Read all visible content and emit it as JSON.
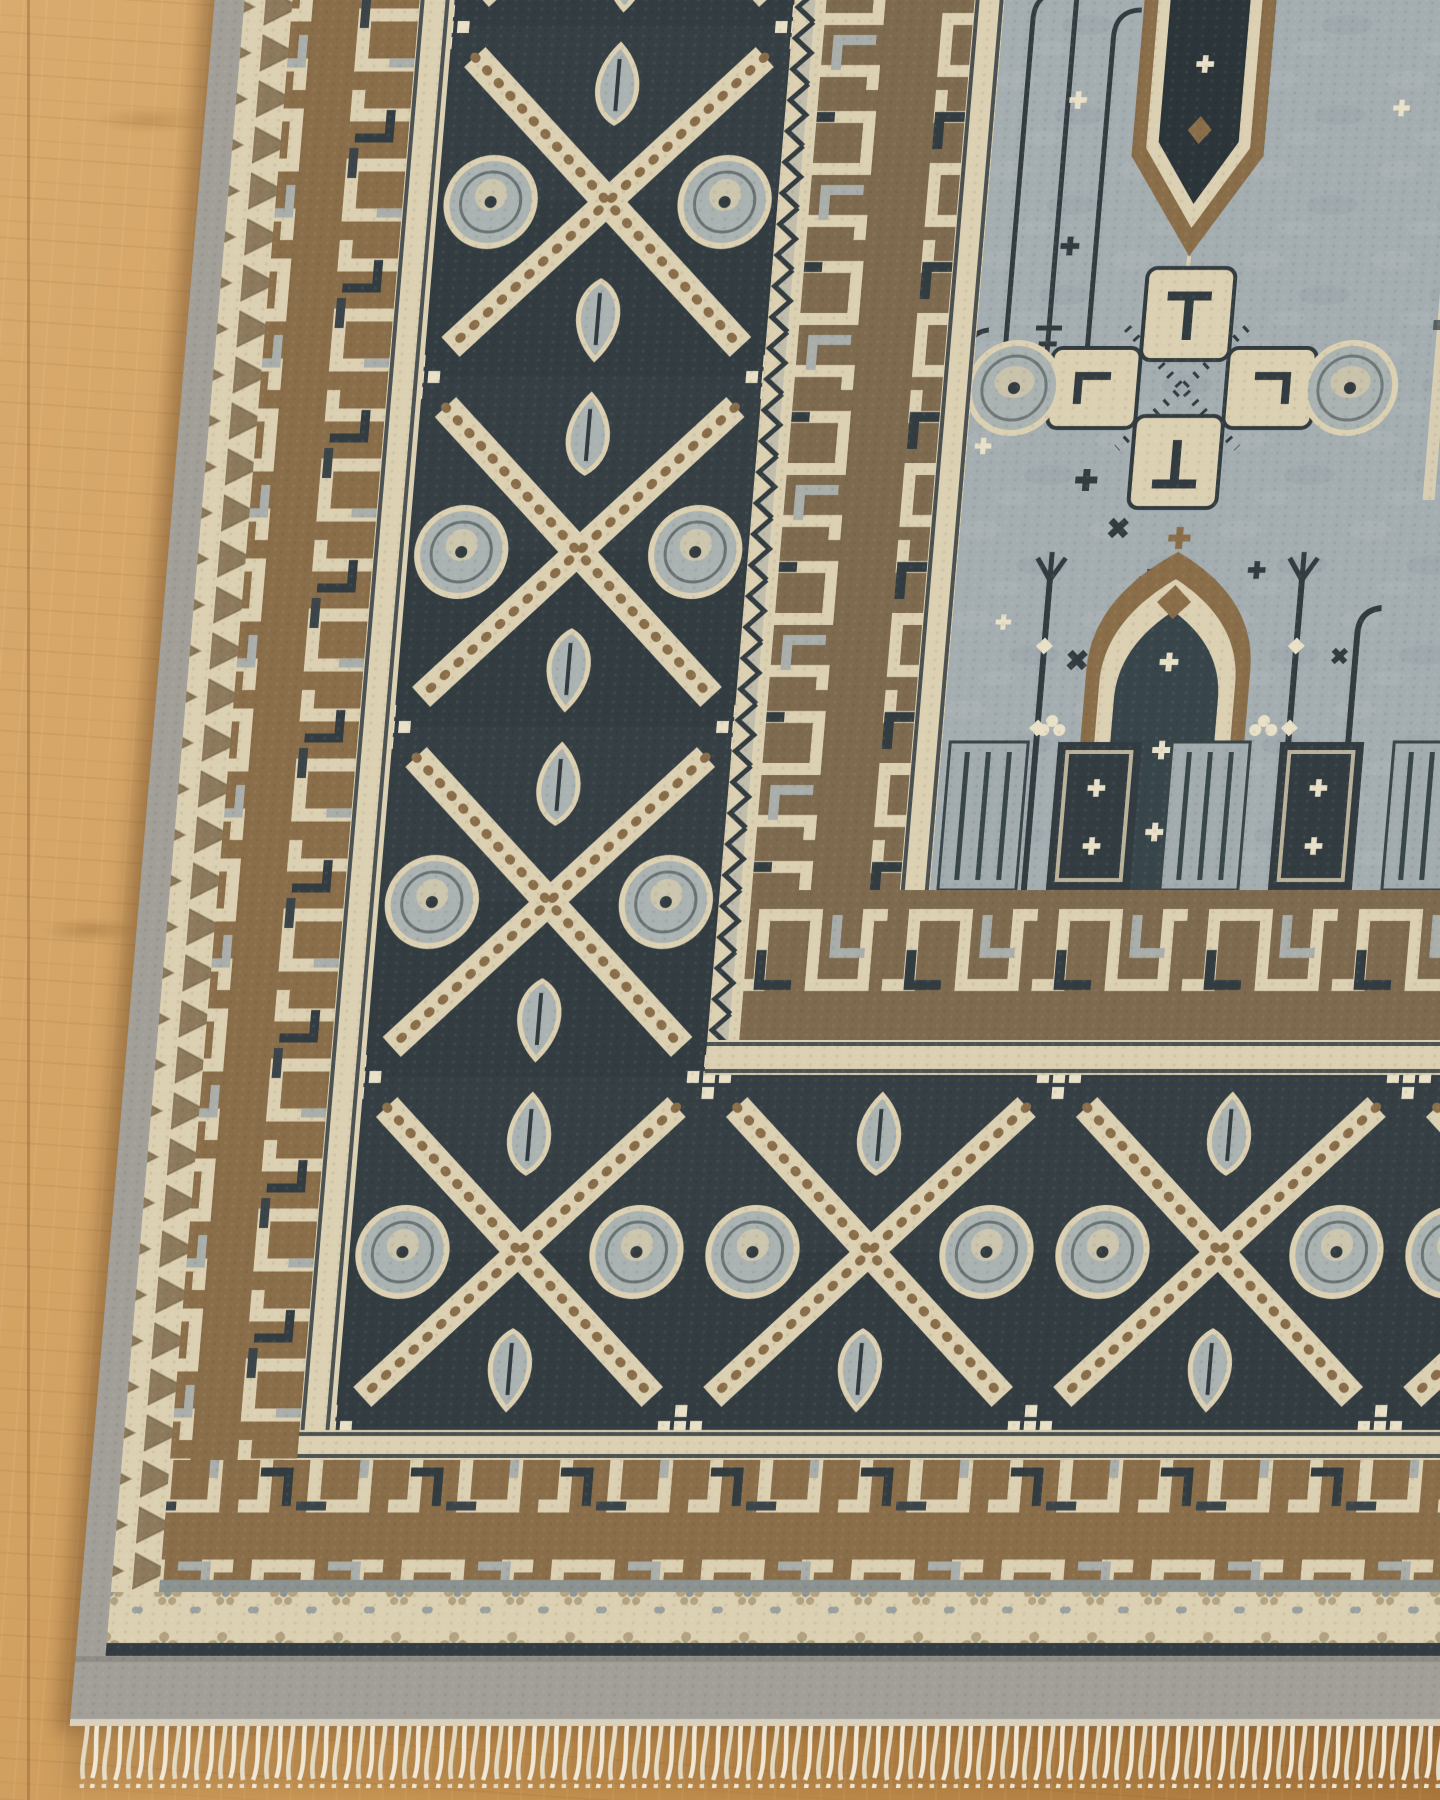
{
  "scene": {
    "type": "photograph",
    "subject": "Corner of a hand-knotted wool area rug lying on an oak hardwood floor",
    "view": "top-down view of the rug's bottom-left corner, cream fringe tassels along the bottom edge, bare wood floor visible at the top-left and left edge"
  },
  "palette": {
    "wood_light": "#d9ab6e",
    "wood_mid": "#c89552",
    "wood_dark": "#ad7a3e",
    "selvage": "#a29f98",
    "selvage_dark": "#8f8d86",
    "cream": "#dcd0b2",
    "cream_bright": "#e9e0c8",
    "navy": "#333d41",
    "navy_deep": "#2c3539",
    "brown": "#8a6e4a",
    "brown_light": "#a98f68",
    "disc": "#aab3b1",
    "field": "#a4adb0",
    "gray_line": "#8b9290",
    "fringe": "#ece4d1"
  },
  "rug": {
    "bands_outer_to_inner": [
      {
        "name": "gray selvage edge",
        "color_key": "selvage"
      },
      {
        "name": "sawtooth guard with brown triangles",
        "color_key": "cream"
      },
      {
        "name": "brown greek-key meander border",
        "color_key": "brown"
      },
      {
        "name": "cream guard stripe",
        "color_key": "cream"
      },
      {
        "name": "main charcoal border with X-medallions, gray discs and palmettes",
        "color_key": "navy"
      },
      {
        "name": "cream zigzag separator",
        "color_key": "cream"
      },
      {
        "name": "inner brown meander border",
        "color_key": "brown"
      },
      {
        "name": "cream inner guard stripe",
        "color_key": "cream"
      },
      {
        "name": "blue-gray field",
        "color_key": "field"
      }
    ],
    "field_motifs": [
      "dark lantern pendant with cream crosses",
      "cream quatrefoil medallion with T glyphs and two gray discs",
      "prayer-arch niche with cream crosses",
      "pole and shepherd-crook stems",
      "scattered dark stars and cream crosses",
      "column-base panels along the field bottom"
    ],
    "bottom_finish": [
      {
        "name": "gray line",
        "color_key": "gray_line"
      },
      {
        "name": "cream flower-dot band",
        "color_key": "cream"
      },
      {
        "name": "navy line",
        "color_key": "navy"
      },
      {
        "name": "plain gray outer band",
        "color_key": "selvage"
      },
      {
        "name": "twisted cream fringe tassels",
        "color_key": "fringe"
      }
    ]
  }
}
